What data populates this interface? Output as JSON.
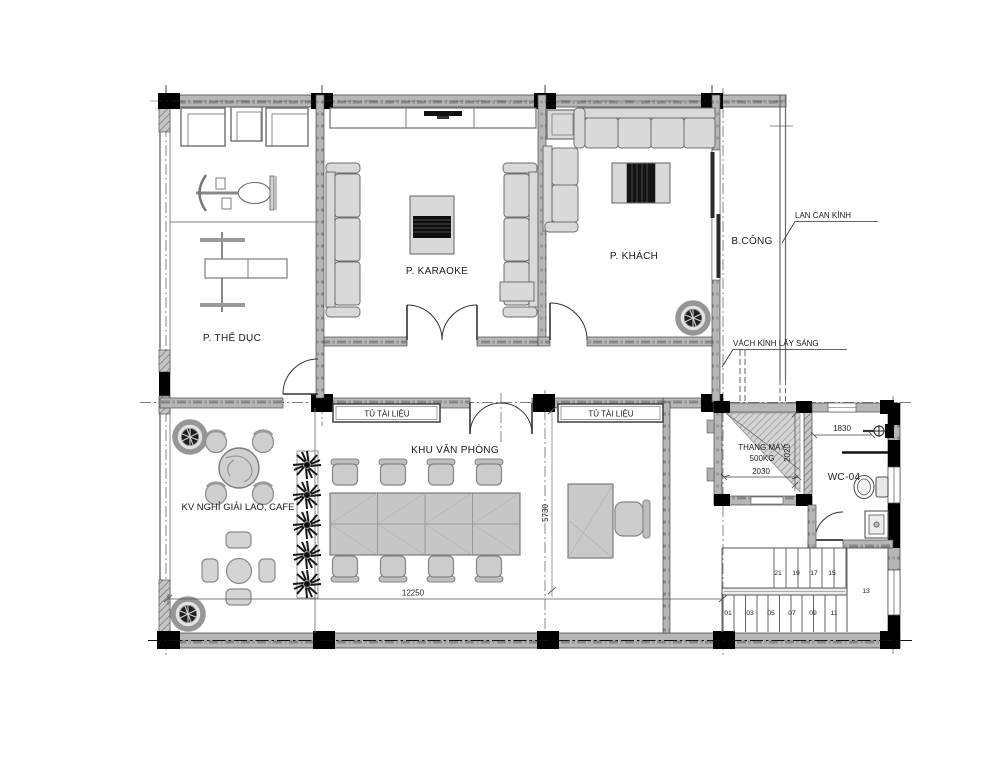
{
  "plan": {
    "rooms": {
      "gym": "P. THỂ DỤC",
      "karaoke": "P. KARAOKE",
      "living": "P. KHÁCH",
      "balcony": "B.CÔNG",
      "office_area": "KHU VĂN PHÒNG",
      "cafe": "KV NGHỈ GIẢI LAO, CAFE",
      "wc": "WC-04"
    },
    "elevator": {
      "name": "THANG MÁY",
      "capacity": "500KG"
    },
    "annotations": {
      "glass_railing": "LAN CAN KÍNH",
      "glass_partition": "VÁCH KÍNH LẤY SÁNG",
      "cabinet_left": "TỦ TÀI LIỆU",
      "cabinet_right": "TỦ TÀI LIỆU"
    },
    "dimensions": {
      "total_width": "12250",
      "office_depth": "5730",
      "wc_width": "1830",
      "elevator_width": "2030",
      "elevator_depth": "2020"
    },
    "stairs": {
      "upper_steps": [
        "21",
        "19",
        "17",
        "15"
      ],
      "landing": "13",
      "lower_steps": [
        "01",
        "03",
        "05",
        "07",
        "09",
        "11"
      ]
    },
    "colors": {
      "wall_gray": "#b4b4b4",
      "column_black": "#000000",
      "furniture_fill": "#d9d9d9",
      "line_dark": "#3c3c3c"
    }
  }
}
